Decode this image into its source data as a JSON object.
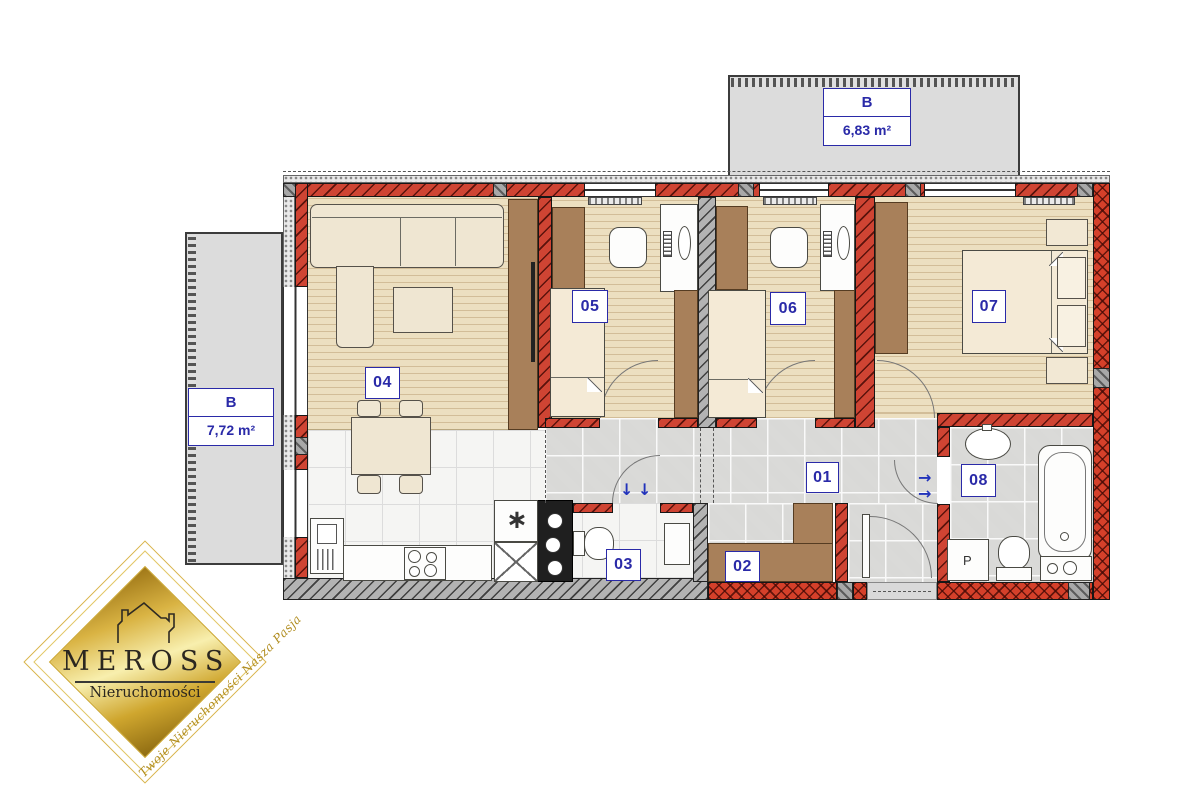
{
  "colors": {
    "accent_blue": "#2a2aa8",
    "wall_red": "#cf4433",
    "gold": "#c9a227"
  },
  "balconies": {
    "top": {
      "label": "B",
      "area": "6,83 m²"
    },
    "left": {
      "label": "B",
      "area": "7,72 m²"
    }
  },
  "rooms": {
    "r01": "01",
    "r02": "02",
    "r03": "03",
    "r04": "04",
    "r05": "05",
    "r06": "06",
    "r07": "07",
    "r08": "08"
  },
  "appliances": {
    "washer": "P"
  },
  "symbols": {
    "arrow_down": "↓",
    "arrow_right": "→",
    "sink_star": "∗"
  },
  "logo": {
    "brand": "MEROSS",
    "subtitle": "Nieruchomości",
    "tagline": "Twoje Nieruchomości Nasza Pasja"
  }
}
